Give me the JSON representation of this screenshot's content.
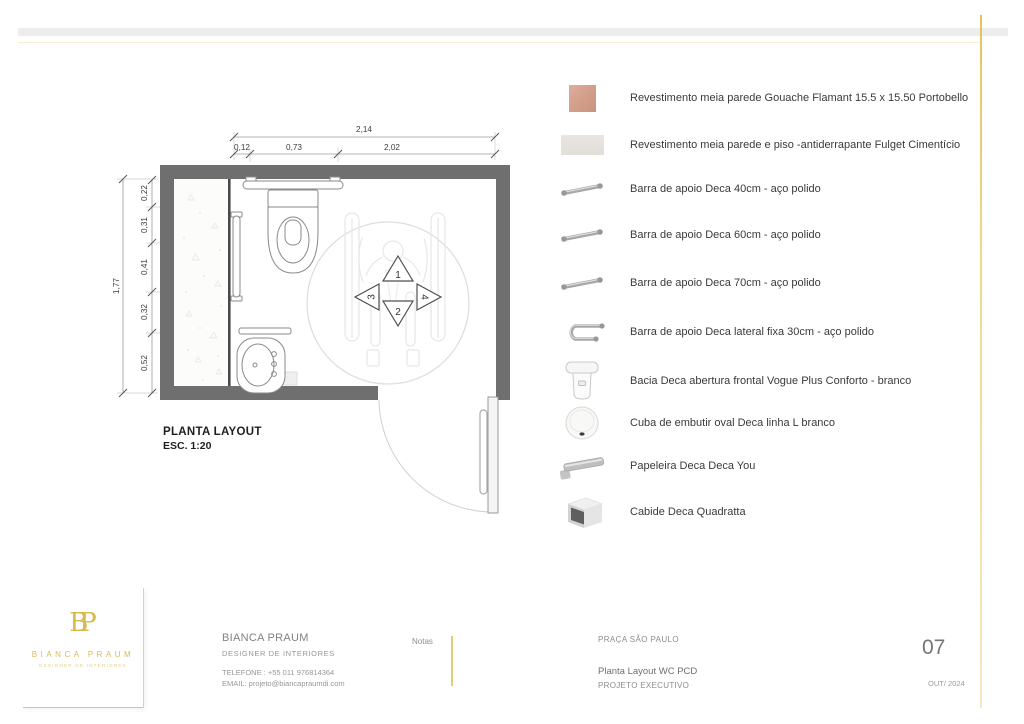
{
  "plan": {
    "title": "PLANTA LAYOUT",
    "scale": "ESC. 1:20",
    "dim_width_total": "2,14",
    "dim_width_segments": [
      "0,12",
      "0,73",
      "2,02"
    ],
    "dim_height_total": "1,77",
    "dim_height_segments": [
      "0,22",
      "0,31",
      "0,41",
      "0,32",
      "0,52"
    ],
    "transfer_arrows": [
      "1",
      "2",
      "3",
      "4"
    ]
  },
  "legend": {
    "items": [
      {
        "icon": "tile-swatch-pink",
        "label": "Revestimento meia parede Gouache Flamant 15.5 x 15.50 Portobello"
      },
      {
        "icon": "tile-swatch-gray",
        "label": "Revestimento meia parede e piso -antiderrapante Fulget Cimentício"
      },
      {
        "icon": "grab-bar",
        "label": "Barra de apoio Deca 40cm - aço polido"
      },
      {
        "icon": "grab-bar",
        "label": "Barra de apoio Deca 60cm - aço polido"
      },
      {
        "icon": "grab-bar",
        "label": "Barra de apoio Deca 70cm - aço polido"
      },
      {
        "icon": "grab-bar-lateral",
        "label": "Barra de apoio Deca lateral fixa 30cm - aço polido"
      },
      {
        "icon": "toilet",
        "label": "Bacia Deca abertura frontal Vogue Plus Conforto - branco"
      },
      {
        "icon": "basin",
        "label": "Cuba de embutir oval Deca linha L branco"
      },
      {
        "icon": "paper-holder",
        "label": "Papeleira Deca Deca You"
      },
      {
        "icon": "hook",
        "label": "Cabide Deca Quadratta"
      }
    ]
  },
  "titleblock": {
    "logo_monogram": "BP",
    "logo_name": "BIANCA PRAUM",
    "logo_tagline": "DESIGNER DE INTERIORES",
    "firm_name": "BIANCA PRAUM",
    "firm_role": "DESIGNER DE INTERIORES",
    "phone": "TELEFONE : +55 011 976814364",
    "email": "EMAIL: projeto@biancapraumdi.com",
    "notes_label": "Notas",
    "location": "PRAÇA SÃO PAULO",
    "drawing_title": "Planta Layout WC PCD",
    "phase": "PROJETO EXECUTIVO",
    "sheet_number": "07",
    "date": "OUT/ 2024"
  },
  "colors": {
    "accent_gold": "#dcc265",
    "wall_gray": "#6f6f6f",
    "tile_pink": "#d6a28f",
    "tile_gray": "#e5e2df"
  }
}
